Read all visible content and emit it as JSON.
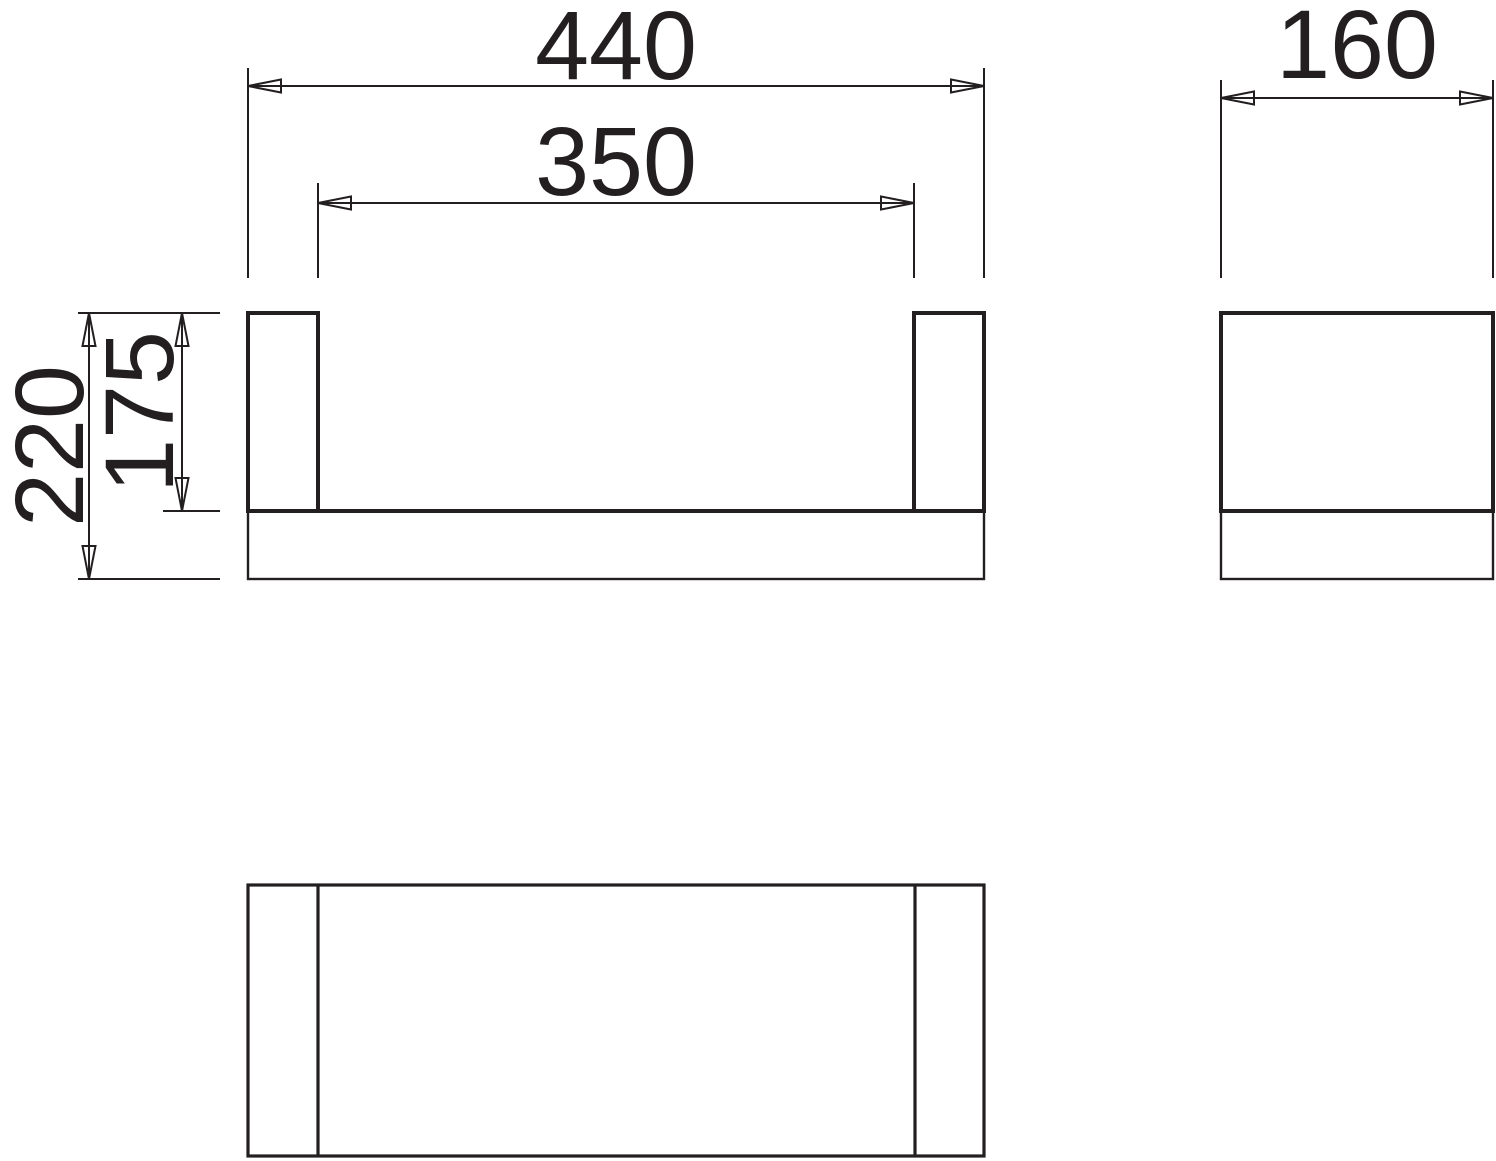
{
  "drawing": {
    "type": "orthographic-projection-technical-drawing",
    "views": {
      "front": "front-view-shelf-with-towel-rail",
      "side": "side-view",
      "top": "top-view"
    },
    "labels": {
      "overall_width": "440",
      "inner_width": "350",
      "depth": "160",
      "overall_height": "220",
      "inner_height": "175"
    },
    "colors": {
      "line": "#231f20",
      "background": "#ffffff"
    }
  }
}
